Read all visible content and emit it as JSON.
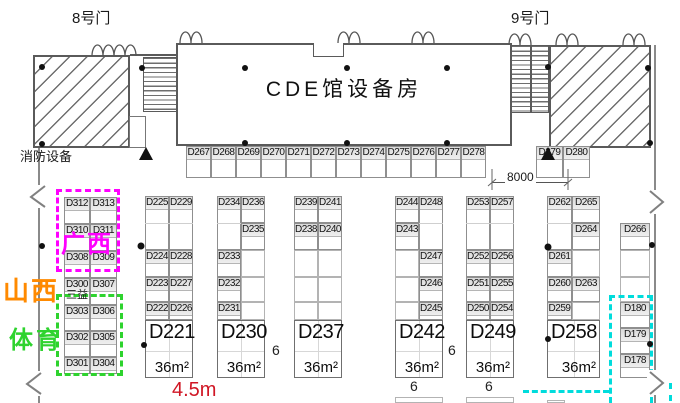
{
  "labels": {
    "gate8": "8号门",
    "gate9": "9号门",
    "hall": "CDE馆设备房",
    "fire": "消防设备",
    "dimension": "8000",
    "aisle_width": "4.5m",
    "corridor": "6",
    "area": "36m²",
    "sanyi": "三益"
  },
  "regions": {
    "guangxi": "广西",
    "shanxi": "山西",
    "sports": "体育"
  },
  "colors": {
    "magenta": "#ff00ff",
    "orange": "#ff8a00",
    "green": "#2ed32e",
    "cyan": "#00dcdc",
    "red": "#d01624"
  },
  "cells": [
    {
      "l": "D267",
      "x": 186,
      "y": 146,
      "w": 25,
      "h": 32
    },
    {
      "l": "D268",
      "x": 211,
      "y": 146,
      "w": 25,
      "h": 32
    },
    {
      "l": "D269",
      "x": 236,
      "y": 146,
      "w": 25,
      "h": 32
    },
    {
      "l": "D270",
      "x": 261,
      "y": 146,
      "w": 25,
      "h": 32
    },
    {
      "l": "D271",
      "x": 286,
      "y": 146,
      "w": 25,
      "h": 32
    },
    {
      "l": "D272",
      "x": 311,
      "y": 146,
      "w": 25,
      "h": 32
    },
    {
      "l": "D273",
      "x": 336,
      "y": 146,
      "w": 25,
      "h": 32
    },
    {
      "l": "D274",
      "x": 361,
      "y": 146,
      "w": 25,
      "h": 32
    },
    {
      "l": "D275",
      "x": 386,
      "y": 146,
      "w": 25,
      "h": 32
    },
    {
      "l": "D276",
      "x": 411,
      "y": 146,
      "w": 25,
      "h": 32
    },
    {
      "l": "D277",
      "x": 436,
      "y": 146,
      "w": 25,
      "h": 32
    },
    {
      "l": "D278",
      "x": 461,
      "y": 146,
      "w": 25,
      "h": 32
    },
    {
      "l": "D279",
      "x": 536,
      "y": 146,
      "w": 27,
      "h": 32
    },
    {
      "l": "D280",
      "x": 563,
      "y": 146,
      "w": 27,
      "h": 32
    },
    {
      "l": "D312",
      "x": 64,
      "y": 197,
      "w": 26,
      "h": 27
    },
    {
      "l": "D313",
      "x": 90,
      "y": 197,
      "w": 27,
      "h": 27
    },
    {
      "l": "D310",
      "x": 64,
      "y": 224,
      "w": 26,
      "h": 27
    },
    {
      "l": "D311",
      "x": 90,
      "y": 224,
      "w": 27,
      "h": 27
    },
    {
      "l": "D308",
      "x": 64,
      "y": 251,
      "w": 26,
      "h": 27
    },
    {
      "l": "D309",
      "x": 90,
      "y": 251,
      "w": 27,
      "h": 27
    },
    {
      "l": "D300",
      "x": 64,
      "y": 278,
      "w": 26,
      "h": 27
    },
    {
      "l": "D307",
      "x": 90,
      "y": 278,
      "w": 27,
      "h": 27
    },
    {
      "l": "D303",
      "x": 64,
      "y": 305,
      "w": 26,
      "h": 26
    },
    {
      "l": "D306",
      "x": 90,
      "y": 305,
      "w": 27,
      "h": 26
    },
    {
      "l": "D302",
      "x": 64,
      "y": 331,
      "w": 26,
      "h": 26
    },
    {
      "l": "D305",
      "x": 90,
      "y": 331,
      "w": 27,
      "h": 26
    },
    {
      "l": "D301",
      "x": 64,
      "y": 357,
      "w": 26,
      "h": 17
    },
    {
      "l": "D304",
      "x": 90,
      "y": 357,
      "w": 27,
      "h": 17
    },
    {
      "l": "D225",
      "x": 145,
      "y": 196,
      "w": 24,
      "h": 54
    },
    {
      "l": "D229",
      "x": 169,
      "y": 196,
      "w": 24,
      "h": 54
    },
    {
      "l": "D224",
      "x": 145,
      "y": 250,
      "w": 24,
      "h": 27
    },
    {
      "l": "D228",
      "x": 169,
      "y": 250,
      "w": 24,
      "h": 27
    },
    {
      "l": "D223",
      "x": 145,
      "y": 277,
      "w": 24,
      "h": 25
    },
    {
      "l": "D227",
      "x": 169,
      "y": 277,
      "w": 24,
      "h": 25
    },
    {
      "l": "D222",
      "x": 145,
      "y": 302,
      "w": 24,
      "h": 18
    },
    {
      "l": "D226",
      "x": 169,
      "y": 302,
      "w": 24,
      "h": 18
    },
    {
      "l": "D221",
      "x": 145,
      "y": 320,
      "w": 48,
      "h": 58,
      "big": 1
    },
    {
      "l": "D234",
      "x": 217,
      "y": 196,
      "w": 24,
      "h": 54
    },
    {
      "l": "D236",
      "x": 241,
      "y": 196,
      "w": 24,
      "h": 27
    },
    {
      "l": "D235",
      "x": 241,
      "y": 223,
      "w": 24,
      "h": 27
    },
    {
      "l": "D233",
      "x": 217,
      "y": 250,
      "w": 24,
      "h": 27
    },
    {
      "l": "",
      "x": 241,
      "y": 250,
      "w": 24,
      "h": 27
    },
    {
      "l": "D232",
      "x": 217,
      "y": 277,
      "w": 24,
      "h": 25
    },
    {
      "l": "",
      "x": 241,
      "y": 277,
      "w": 24,
      "h": 25
    },
    {
      "l": "D231",
      "x": 217,
      "y": 302,
      "w": 24,
      "h": 18
    },
    {
      "l": "",
      "x": 241,
      "y": 302,
      "w": 24,
      "h": 18
    },
    {
      "l": "D230",
      "x": 217,
      "y": 320,
      "w": 48,
      "h": 58,
      "big": 1
    },
    {
      "l": "D239",
      "x": 294,
      "y": 196,
      "w": 24,
      "h": 27
    },
    {
      "l": "D241",
      "x": 318,
      "y": 196,
      "w": 24,
      "h": 27
    },
    {
      "l": "D238",
      "x": 294,
      "y": 223,
      "w": 24,
      "h": 27
    },
    {
      "l": "D240",
      "x": 318,
      "y": 223,
      "w": 24,
      "h": 27
    },
    {
      "l": "",
      "x": 294,
      "y": 250,
      "w": 24,
      "h": 27
    },
    {
      "l": "",
      "x": 318,
      "y": 250,
      "w": 24,
      "h": 27
    },
    {
      "l": "",
      "x": 294,
      "y": 277,
      "w": 24,
      "h": 25
    },
    {
      "l": "",
      "x": 318,
      "y": 277,
      "w": 24,
      "h": 25
    },
    {
      "l": "",
      "x": 294,
      "y": 302,
      "w": 24,
      "h": 18
    },
    {
      "l": "",
      "x": 318,
      "y": 302,
      "w": 24,
      "h": 18
    },
    {
      "l": "D237",
      "x": 294,
      "y": 320,
      "w": 48,
      "h": 58,
      "big": 1
    },
    {
      "l": "D244",
      "x": 395,
      "y": 196,
      "w": 24,
      "h": 27
    },
    {
      "l": "D248",
      "x": 419,
      "y": 196,
      "w": 24,
      "h": 54
    },
    {
      "l": "D243",
      "x": 395,
      "y": 223,
      "w": 24,
      "h": 27
    },
    {
      "l": "",
      "x": 395,
      "y": 250,
      "w": 24,
      "h": 27
    },
    {
      "l": "D247",
      "x": 419,
      "y": 250,
      "w": 24,
      "h": 27
    },
    {
      "l": "",
      "x": 395,
      "y": 277,
      "w": 24,
      "h": 25
    },
    {
      "l": "D246",
      "x": 419,
      "y": 277,
      "w": 24,
      "h": 25
    },
    {
      "l": "",
      "x": 395,
      "y": 302,
      "w": 24,
      "h": 18
    },
    {
      "l": "D245",
      "x": 419,
      "y": 302,
      "w": 24,
      "h": 18
    },
    {
      "l": "D242",
      "x": 395,
      "y": 320,
      "w": 48,
      "h": 58,
      "big": 1
    },
    {
      "l": "D253",
      "x": 466,
      "y": 196,
      "w": 24,
      "h": 54
    },
    {
      "l": "D257",
      "x": 490,
      "y": 196,
      "w": 24,
      "h": 54
    },
    {
      "l": "D252",
      "x": 466,
      "y": 250,
      "w": 24,
      "h": 27
    },
    {
      "l": "D256",
      "x": 490,
      "y": 250,
      "w": 24,
      "h": 27
    },
    {
      "l": "D251",
      "x": 466,
      "y": 277,
      "w": 24,
      "h": 25
    },
    {
      "l": "D255",
      "x": 490,
      "y": 277,
      "w": 24,
      "h": 25
    },
    {
      "l": "D250",
      "x": 466,
      "y": 302,
      "w": 24,
      "h": 18
    },
    {
      "l": "D254",
      "x": 490,
      "y": 302,
      "w": 24,
      "h": 18
    },
    {
      "l": "D249",
      "x": 466,
      "y": 320,
      "w": 48,
      "h": 58,
      "big": 1
    },
    {
      "l": "D262",
      "x": 547,
      "y": 196,
      "w": 25,
      "h": 54
    },
    {
      "l": "D265",
      "x": 572,
      "y": 196,
      "w": 28,
      "h": 27
    },
    {
      "l": "D264",
      "x": 572,
      "y": 223,
      "w": 28,
      "h": 27
    },
    {
      "l": "D261",
      "x": 547,
      "y": 250,
      "w": 25,
      "h": 27
    },
    {
      "l": "",
      "x": 572,
      "y": 250,
      "w": 28,
      "h": 27
    },
    {
      "l": "D260",
      "x": 547,
      "y": 277,
      "w": 25,
      "h": 25
    },
    {
      "l": "D263",
      "x": 572,
      "y": 277,
      "w": 28,
      "h": 25
    },
    {
      "l": "D259",
      "x": 547,
      "y": 302,
      "w": 25,
      "h": 18
    },
    {
      "l": "",
      "x": 572,
      "y": 302,
      "w": 28,
      "h": 18
    },
    {
      "l": "D258",
      "x": 547,
      "y": 320,
      "w": 53,
      "h": 58,
      "big": 1
    },
    {
      "l": "D266",
      "x": 620,
      "y": 223,
      "w": 30,
      "h": 27
    },
    {
      "l": "",
      "x": 620,
      "y": 250,
      "w": 30,
      "h": 27
    },
    {
      "l": "",
      "x": 620,
      "y": 277,
      "w": 30,
      "h": 25
    },
    {
      "l": "D180",
      "x": 620,
      "y": 302,
      "w": 30,
      "h": 26
    },
    {
      "l": "D179",
      "x": 620,
      "y": 328,
      "w": 30,
      "h": 26
    },
    {
      "l": "D178",
      "x": 620,
      "y": 354,
      "w": 30,
      "h": 24
    },
    {
      "l": "",
      "x": 395,
      "y": 397,
      "w": 48,
      "h": 6
    },
    {
      "l": "",
      "x": 466,
      "y": 397,
      "w": 48,
      "h": 6
    },
    {
      "l": "",
      "x": 547,
      "y": 400,
      "w": 18,
      "h": 3
    }
  ],
  "faint_lines": [
    {
      "x": 145,
      "y": 223,
      "w": 48
    },
    {
      "x": 217,
      "y": 223,
      "w": 24
    },
    {
      "x": 419,
      "y": 223,
      "w": 24
    },
    {
      "x": 466,
      "y": 223,
      "w": 48
    },
    {
      "x": 547,
      "y": 223,
      "w": 25
    }
  ]
}
